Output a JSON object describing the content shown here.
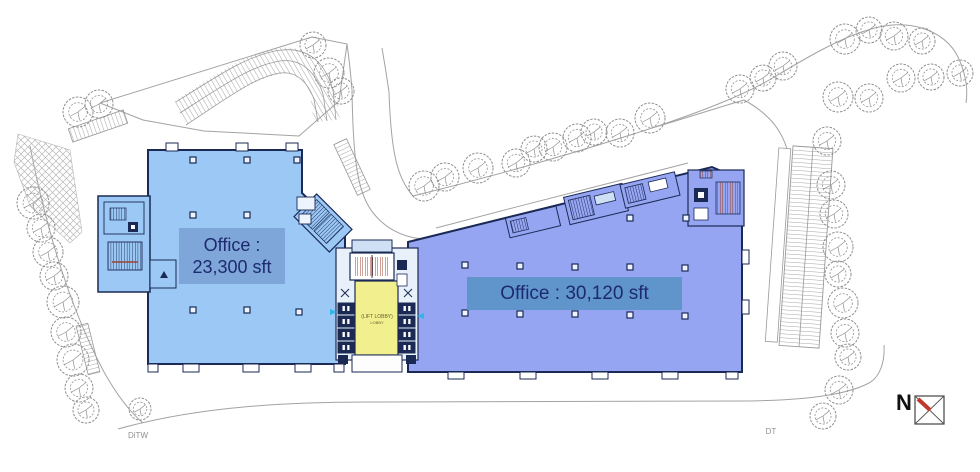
{
  "labels": {
    "left_building": {
      "line1": "Office :",
      "line2": "23,300 sft"
    },
    "right_building": {
      "text": "Office : 30,120 sft"
    },
    "lobby": {
      "line1": "(LIFT LOBBY)",
      "line2": "LOBBY"
    },
    "north": "N",
    "road_left": "DiTW",
    "road_right": "DT"
  },
  "colors": {
    "left_building_fill": "#9bc8f5",
    "right_building_fill": "#96a5f2",
    "building_outline": "#1b2a55",
    "label_band_left": "#7fa6d8",
    "label_band_right": "#6095cb",
    "label_text": "#1e2a70",
    "core_yellow": "#f2ef8e",
    "stair_red": "#9c4430",
    "site_line_grey": "#a3a3a3",
    "tree_grey": "#8f8f8f",
    "north_red": "#c0392b"
  },
  "site": {
    "trees": [
      [
        33,
        203,
        16
      ],
      [
        41,
        228,
        14
      ],
      [
        48,
        252,
        15
      ],
      [
        54,
        276,
        14
      ],
      [
        63,
        302,
        16
      ],
      [
        66,
        332,
        15
      ],
      [
        73,
        360,
        16
      ],
      [
        79,
        388,
        14
      ],
      [
        86,
        410,
        13
      ],
      [
        140,
        409,
        11
      ],
      [
        78,
        112,
        15
      ],
      [
        99,
        104,
        14
      ],
      [
        313,
        45,
        13
      ],
      [
        329,
        73,
        15
      ],
      [
        341,
        91,
        13
      ],
      [
        424,
        186,
        15
      ],
      [
        445,
        177,
        14
      ],
      [
        478,
        168,
        15
      ],
      [
        516,
        163,
        14
      ],
      [
        534,
        149,
        13
      ],
      [
        553,
        147,
        14
      ],
      [
        577,
        138,
        14
      ],
      [
        594,
        132,
        13
      ],
      [
        620,
        133,
        14
      ],
      [
        650,
        118,
        15
      ],
      [
        740,
        89,
        14
      ],
      [
        763,
        78,
        13
      ],
      [
        783,
        66,
        14
      ],
      [
        845,
        39,
        15
      ],
      [
        869,
        30,
        13
      ],
      [
        894,
        36,
        14
      ],
      [
        922,
        41,
        13
      ],
      [
        838,
        97,
        15
      ],
      [
        869,
        98,
        14
      ],
      [
        901,
        78,
        14
      ],
      [
        931,
        77,
        13
      ],
      [
        960,
        73,
        13
      ],
      [
        827,
        141,
        14
      ],
      [
        831,
        185,
        14
      ],
      [
        834,
        214,
        14
      ],
      [
        838,
        247,
        15
      ],
      [
        838,
        274,
        13
      ],
      [
        843,
        303,
        15
      ],
      [
        845,
        333,
        14
      ],
      [
        848,
        357,
        13
      ],
      [
        839,
        390,
        14
      ],
      [
        823,
        416,
        13
      ]
    ],
    "columns_left": [
      [
        193,
        160
      ],
      [
        247,
        160
      ],
      [
        297,
        160
      ],
      [
        193,
        215
      ],
      [
        247,
        215
      ],
      [
        193,
        310
      ],
      [
        247,
        310
      ],
      [
        299,
        312
      ]
    ],
    "columns_right": [
      [
        465,
        265
      ],
      [
        520,
        266
      ],
      [
        575,
        267
      ],
      [
        630,
        267
      ],
      [
        685,
        268
      ],
      [
        465,
        313
      ],
      [
        520,
        314
      ],
      [
        575,
        314
      ],
      [
        630,
        315
      ],
      [
        685,
        316
      ],
      [
        630,
        218
      ],
      [
        686,
        218
      ]
    ],
    "elevator_cells": [
      [
        338,
        303
      ],
      [
        338,
        316
      ],
      [
        338,
        329
      ],
      [
        338,
        342
      ],
      [
        399,
        303
      ],
      [
        399,
        316
      ],
      [
        399,
        329
      ],
      [
        399,
        342
      ]
    ]
  }
}
